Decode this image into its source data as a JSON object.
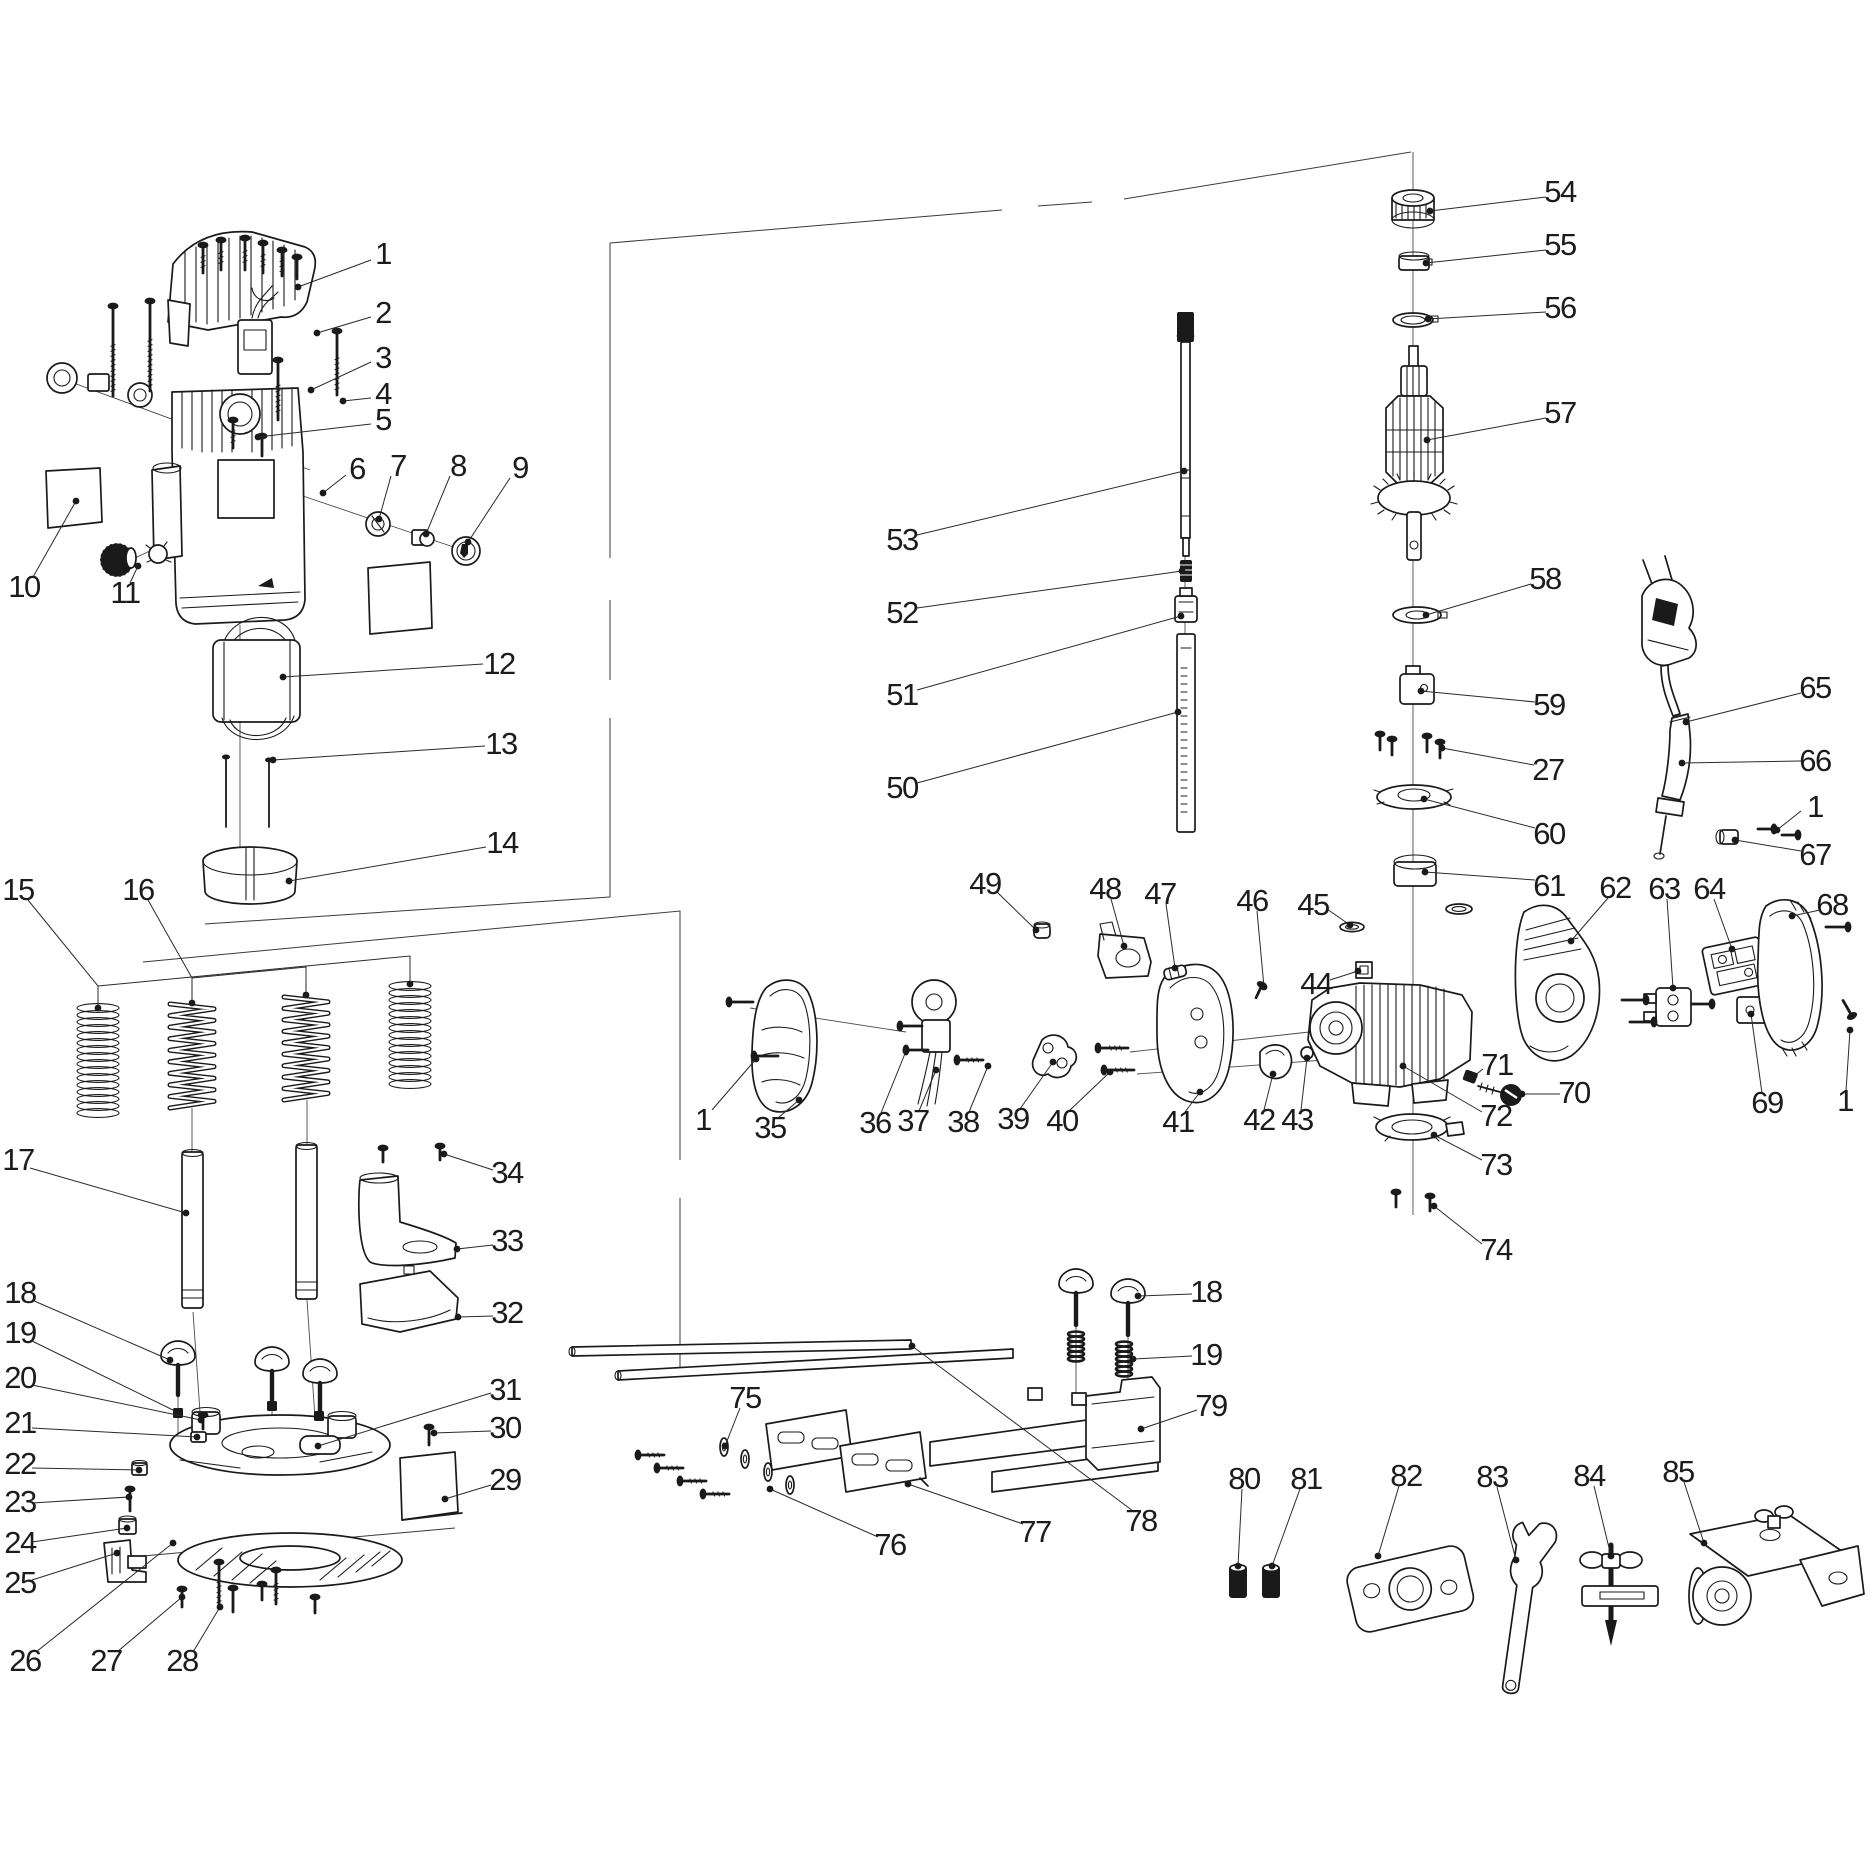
{
  "document": {
    "kind": "exploded-parts-diagram",
    "subject": "plunge router power tool parts schematic",
    "background_color": "#ffffff",
    "line_color": "#1a1a1a",
    "label_font_size": 31
  },
  "labels": [
    {
      "n": "1",
      "x": 383,
      "y": 254,
      "l": [
        [
          371,
          260
        ],
        [
          298,
          287
        ]
      ]
    },
    {
      "n": "2",
      "x": 383,
      "y": 313,
      "l": [
        [
          371,
          317
        ],
        [
          317,
          333
        ]
      ]
    },
    {
      "n": "3",
      "x": 383,
      "y": 358,
      "l": [
        [
          371,
          362
        ],
        [
          311,
          390
        ]
      ]
    },
    {
      "n": "4",
      "x": 383,
      "y": 394,
      "l": [
        [
          371,
          398
        ],
        [
          343,
          401
        ]
      ]
    },
    {
      "n": "5",
      "x": 383,
      "y": 420,
      "l": [
        [
          371,
          424
        ],
        [
          258,
          437
        ]
      ]
    },
    {
      "n": "6",
      "x": 357,
      "y": 469,
      "l": [
        [
          346,
          475
        ],
        [
          323,
          493
        ]
      ]
    },
    {
      "n": "7",
      "x": 398,
      "y": 466,
      "l": [
        [
          391,
          476
        ],
        [
          379,
          519
        ]
      ]
    },
    {
      "n": "8",
      "x": 458,
      "y": 466,
      "l": [
        [
          450,
          476
        ],
        [
          426,
          534
        ]
      ]
    },
    {
      "n": "9",
      "x": 520,
      "y": 468,
      "l": [
        [
          510,
          478
        ],
        [
          468,
          542
        ]
      ]
    },
    {
      "n": "10",
      "x": 24,
      "y": 587,
      "l": [
        [
          33,
          577
        ],
        [
          76,
          501
        ]
      ]
    },
    {
      "n": "11",
      "x": 125,
      "y": 593,
      "l": [
        [
          130,
          583
        ],
        [
          138,
          566
        ]
      ]
    },
    {
      "n": "12",
      "x": 499,
      "y": 664,
      "l": [
        [
          483,
          664
        ],
        [
          283,
          677
        ]
      ]
    },
    {
      "n": "13",
      "x": 501,
      "y": 744,
      "l": [
        [
          485,
          746
        ],
        [
          273,
          760
        ]
      ]
    },
    {
      "n": "14",
      "x": 502,
      "y": 843,
      "l": [
        [
          486,
          847
        ],
        [
          289,
          881
        ]
      ]
    },
    {
      "n": "15",
      "x": 18,
      "y": 890,
      "l": [
        [
          28,
          900
        ],
        [
          98,
          986
        ],
        [
          98,
          1008
        ]
      ],
      "l2": [
        [
          98,
          986
        ],
        [
          410,
          956
        ],
        [
          410,
          984
        ]
      ]
    },
    {
      "n": "16",
      "x": 138,
      "y": 890,
      "l": [
        [
          148,
          900
        ],
        [
          192,
          978
        ],
        [
          192,
          1003
        ]
      ],
      "l2": [
        [
          192,
          978
        ],
        [
          306,
          967
        ],
        [
          306,
          995
        ]
      ]
    },
    {
      "n": "17",
      "x": 18,
      "y": 1160,
      "l": [
        [
          30,
          1168
        ],
        [
          186,
          1213
        ]
      ]
    },
    {
      "n": "18",
      "x": 20,
      "y": 1293,
      "l": [
        [
          32,
          1300
        ],
        [
          170,
          1360
        ]
      ]
    },
    {
      "n": "19",
      "x": 20,
      "y": 1333,
      "l": [
        [
          32,
          1341
        ],
        [
          177,
          1412
        ]
      ]
    },
    {
      "n": "20",
      "x": 20,
      "y": 1378,
      "l": [
        [
          32,
          1385
        ],
        [
          201,
          1420
        ]
      ]
    },
    {
      "n": "21",
      "x": 20,
      "y": 1423,
      "l": [
        [
          32,
          1428
        ],
        [
          197,
          1437
        ]
      ]
    },
    {
      "n": "22",
      "x": 20,
      "y": 1464,
      "l": [
        [
          32,
          1468
        ],
        [
          139,
          1470
        ]
      ]
    },
    {
      "n": "23",
      "x": 20,
      "y": 1502,
      "l": [
        [
          32,
          1503
        ],
        [
          129,
          1497
        ]
      ]
    },
    {
      "n": "24",
      "x": 20,
      "y": 1543,
      "l": [
        [
          32,
          1542
        ],
        [
          127,
          1528
        ]
      ]
    },
    {
      "n": "25",
      "x": 20,
      "y": 1583,
      "l": [
        [
          32,
          1580
        ],
        [
          117,
          1553
        ]
      ]
    },
    {
      "n": "26",
      "x": 25,
      "y": 1661,
      "l": [
        [
          36,
          1652
        ],
        [
          173,
          1543
        ]
      ]
    },
    {
      "n": "27",
      "x": 106,
      "y": 1661,
      "l": [
        [
          117,
          1652
        ],
        [
          182,
          1597
        ]
      ]
    },
    {
      "n": "28",
      "x": 182,
      "y": 1661,
      "l": [
        [
          193,
          1652
        ],
        [
          220,
          1607
        ]
      ]
    },
    {
      "n": "29",
      "x": 505,
      "y": 1480,
      "l": [
        [
          491,
          1485
        ],
        [
          445,
          1499
        ]
      ]
    },
    {
      "n": "30",
      "x": 505,
      "y": 1428,
      "l": [
        [
          491,
          1431
        ],
        [
          434,
          1433
        ]
      ]
    },
    {
      "n": "31",
      "x": 505,
      "y": 1390,
      "l": [
        [
          491,
          1393
        ],
        [
          318,
          1446
        ]
      ]
    },
    {
      "n": "32",
      "x": 507,
      "y": 1313,
      "l": [
        [
          493,
          1316
        ],
        [
          458,
          1317
        ]
      ]
    },
    {
      "n": "33",
      "x": 507,
      "y": 1241,
      "l": [
        [
          493,
          1245
        ],
        [
          457,
          1249
        ]
      ]
    },
    {
      "n": "34",
      "x": 507,
      "y": 1173,
      "l": [
        [
          493,
          1170
        ],
        [
          444,
          1154
        ]
      ]
    },
    {
      "n": "1",
      "x": 703,
      "y": 1120,
      "l": [
        [
          712,
          1110
        ],
        [
          756,
          1059
        ]
      ]
    },
    {
      "n": "35",
      "x": 770,
      "y": 1128,
      "l": [
        [
          778,
          1118
        ],
        [
          799,
          1100
        ]
      ]
    },
    {
      "n": "36",
      "x": 875,
      "y": 1123,
      "l": [
        [
          881,
          1113
        ],
        [
          906,
          1051
        ]
      ]
    },
    {
      "n": "37",
      "x": 913,
      "y": 1121,
      "l": [
        [
          919,
          1111
        ],
        [
          936,
          1070
        ]
      ]
    },
    {
      "n": "38",
      "x": 963,
      "y": 1122,
      "l": [
        [
          969,
          1112
        ],
        [
          988,
          1066
        ]
      ]
    },
    {
      "n": "39",
      "x": 1013,
      "y": 1119,
      "l": [
        [
          1020,
          1109
        ],
        [
          1053,
          1062
        ]
      ]
    },
    {
      "n": "40",
      "x": 1062,
      "y": 1121,
      "l": [
        [
          1069,
          1111
        ],
        [
          1110,
          1072
        ]
      ]
    },
    {
      "n": "41",
      "x": 1178,
      "y": 1122,
      "l": [
        [
          1185,
          1112
        ],
        [
          1200,
          1092
        ]
      ]
    },
    {
      "n": "42",
      "x": 1259,
      "y": 1120,
      "l": [
        [
          1264,
          1110
        ],
        [
          1273,
          1074
        ]
      ]
    },
    {
      "n": "43",
      "x": 1297,
      "y": 1120,
      "l": [
        [
          1301,
          1110
        ],
        [
          1307,
          1058
        ]
      ]
    },
    {
      "n": "44",
      "x": 1316,
      "y": 984,
      "l": [
        [
          1330,
          980
        ],
        [
          1358,
          971
        ]
      ]
    },
    {
      "n": "45",
      "x": 1313,
      "y": 905,
      "l": [
        [
          1327,
          909
        ],
        [
          1350,
          925
        ]
      ]
    },
    {
      "n": "46",
      "x": 1252,
      "y": 901,
      "l": [
        [
          1257,
          911
        ],
        [
          1264,
          987
        ]
      ]
    },
    {
      "n": "47",
      "x": 1160,
      "y": 894,
      "l": [
        [
          1166,
          904
        ],
        [
          1175,
          968
        ]
      ]
    },
    {
      "n": "48",
      "x": 1105,
      "y": 889,
      "l": [
        [
          1111,
          899
        ],
        [
          1124,
          946
        ]
      ]
    },
    {
      "n": "49",
      "x": 985,
      "y": 884,
      "l": [
        [
          997,
          892
        ],
        [
          1036,
          930
        ]
      ]
    },
    {
      "n": "50",
      "x": 902,
      "y": 788,
      "l": [
        [
          917,
          783
        ],
        [
          1178,
          712
        ]
      ]
    },
    {
      "n": "51",
      "x": 902,
      "y": 695,
      "l": [
        [
          917,
          690
        ],
        [
          1181,
          616
        ]
      ]
    },
    {
      "n": "52",
      "x": 902,
      "y": 613,
      "l": [
        [
          917,
          608
        ],
        [
          1182,
          571
        ]
      ]
    },
    {
      "n": "53",
      "x": 902,
      "y": 540,
      "l": [
        [
          917,
          535
        ],
        [
          1184,
          471
        ]
      ]
    },
    {
      "n": "54",
      "x": 1560,
      "y": 192,
      "l": [
        [
          1546,
          197
        ],
        [
          1430,
          211
        ]
      ]
    },
    {
      "n": "55",
      "x": 1560,
      "y": 245,
      "l": [
        [
          1546,
          250
        ],
        [
          1426,
          263
        ]
      ]
    },
    {
      "n": "56",
      "x": 1560,
      "y": 308,
      "l": [
        [
          1546,
          312
        ],
        [
          1428,
          319
        ]
      ]
    },
    {
      "n": "57",
      "x": 1560,
      "y": 413,
      "l": [
        [
          1546,
          418
        ],
        [
          1427,
          440
        ]
      ]
    },
    {
      "n": "58",
      "x": 1545,
      "y": 579,
      "l": [
        [
          1531,
          584
        ],
        [
          1426,
          615
        ]
      ]
    },
    {
      "n": "59",
      "x": 1549,
      "y": 705,
      "l": [
        [
          1535,
          702
        ],
        [
          1421,
          691
        ]
      ]
    },
    {
      "n": "27",
      "x": 1548,
      "y": 770,
      "l": [
        [
          1534,
          765
        ],
        [
          1442,
          748
        ]
      ]
    },
    {
      "n": "60",
      "x": 1549,
      "y": 834,
      "l": [
        [
          1535,
          828
        ],
        [
          1424,
          799
        ]
      ]
    },
    {
      "n": "61",
      "x": 1549,
      "y": 886,
      "l": [
        [
          1535,
          880
        ],
        [
          1425,
          872
        ]
      ]
    },
    {
      "n": "62",
      "x": 1615,
      "y": 888,
      "l": [
        [
          1608,
          898
        ],
        [
          1571,
          941
        ]
      ]
    },
    {
      "n": "63",
      "x": 1664,
      "y": 889,
      "l": [
        [
          1667,
          899
        ],
        [
          1673,
          988
        ]
      ]
    },
    {
      "n": "64",
      "x": 1709,
      "y": 889,
      "l": [
        [
          1714,
          899
        ],
        [
          1732,
          949
        ]
      ]
    },
    {
      "n": "65",
      "x": 1815,
      "y": 688,
      "l": [
        [
          1801,
          693
        ],
        [
          1686,
          722
        ]
      ]
    },
    {
      "n": "66",
      "x": 1815,
      "y": 761,
      "l": [
        [
          1801,
          761
        ],
        [
          1682,
          763
        ]
      ]
    },
    {
      "n": "1",
      "x": 1815,
      "y": 807,
      "l": [
        [
          1801,
          811
        ],
        [
          1777,
          830
        ]
      ]
    },
    {
      "n": "67",
      "x": 1815,
      "y": 855,
      "l": [
        [
          1801,
          851
        ],
        [
          1735,
          840
        ]
      ]
    },
    {
      "n": "68",
      "x": 1832,
      "y": 905,
      "l": [
        [
          1820,
          910
        ],
        [
          1792,
          916
        ]
      ]
    },
    {
      "n": "69",
      "x": 1767,
      "y": 1103,
      "l": [
        [
          1762,
          1093
        ],
        [
          1751,
          1014
        ]
      ]
    },
    {
      "n": "1",
      "x": 1845,
      "y": 1101,
      "l": [
        [
          1846,
          1091
        ],
        [
          1850,
          1030
        ]
      ]
    },
    {
      "n": "70",
      "x": 1574,
      "y": 1093,
      "l": [
        [
          1560,
          1094
        ],
        [
          1522,
          1094
        ]
      ]
    },
    {
      "n": "71",
      "x": 1497,
      "y": 1065,
      "l": [
        [
          1483,
          1069
        ],
        [
          1474,
          1076
        ]
      ]
    },
    {
      "n": "72",
      "x": 1496,
      "y": 1116,
      "l": [
        [
          1482,
          1112
        ],
        [
          1403,
          1066
        ]
      ]
    },
    {
      "n": "73",
      "x": 1496,
      "y": 1165,
      "l": [
        [
          1482,
          1160
        ],
        [
          1434,
          1135
        ]
      ]
    },
    {
      "n": "74",
      "x": 1496,
      "y": 1250,
      "l": [
        [
          1482,
          1244
        ],
        [
          1434,
          1206
        ]
      ]
    },
    {
      "n": "75",
      "x": 745,
      "y": 1398,
      "l": [
        [
          740,
          1408
        ],
        [
          725,
          1446
        ]
      ]
    },
    {
      "n": "76",
      "x": 890,
      "y": 1545,
      "l": [
        [
          878,
          1537
        ],
        [
          770,
          1489
        ]
      ]
    },
    {
      "n": "77",
      "x": 1035,
      "y": 1532,
      "l": [
        [
          1023,
          1524
        ],
        [
          908,
          1484
        ]
      ]
    },
    {
      "n": "78",
      "x": 1141,
      "y": 1521,
      "l": [
        [
          1133,
          1511
        ],
        [
          912,
          1346
        ]
      ]
    },
    {
      "n": "79",
      "x": 1211,
      "y": 1406,
      "l": [
        [
          1197,
          1410
        ],
        [
          1141,
          1429
        ]
      ]
    },
    {
      "n": "18",
      "x": 1206,
      "y": 1292,
      "l": [
        [
          1192,
          1294
        ],
        [
          1138,
          1296
        ]
      ]
    },
    {
      "n": "19",
      "x": 1206,
      "y": 1355,
      "l": [
        [
          1192,
          1356
        ],
        [
          1133,
          1359
        ]
      ]
    },
    {
      "n": "80",
      "x": 1244,
      "y": 1479,
      "l": [
        [
          1242,
          1489
        ],
        [
          1238,
          1566
        ]
      ]
    },
    {
      "n": "81",
      "x": 1306,
      "y": 1479,
      "l": [
        [
          1300,
          1489
        ],
        [
          1272,
          1566
        ]
      ]
    },
    {
      "n": "82",
      "x": 1406,
      "y": 1476,
      "l": [
        [
          1399,
          1486
        ],
        [
          1378,
          1556
        ]
      ]
    },
    {
      "n": "83",
      "x": 1492,
      "y": 1477,
      "l": [
        [
          1497,
          1487
        ],
        [
          1516,
          1560
        ]
      ]
    },
    {
      "n": "84",
      "x": 1589,
      "y": 1476,
      "l": [
        [
          1594,
          1486
        ],
        [
          1611,
          1556
        ]
      ]
    },
    {
      "n": "85",
      "x": 1678,
      "y": 1472,
      "l": [
        [
          1684,
          1482
        ],
        [
          1704,
          1543
        ]
      ]
    }
  ]
}
